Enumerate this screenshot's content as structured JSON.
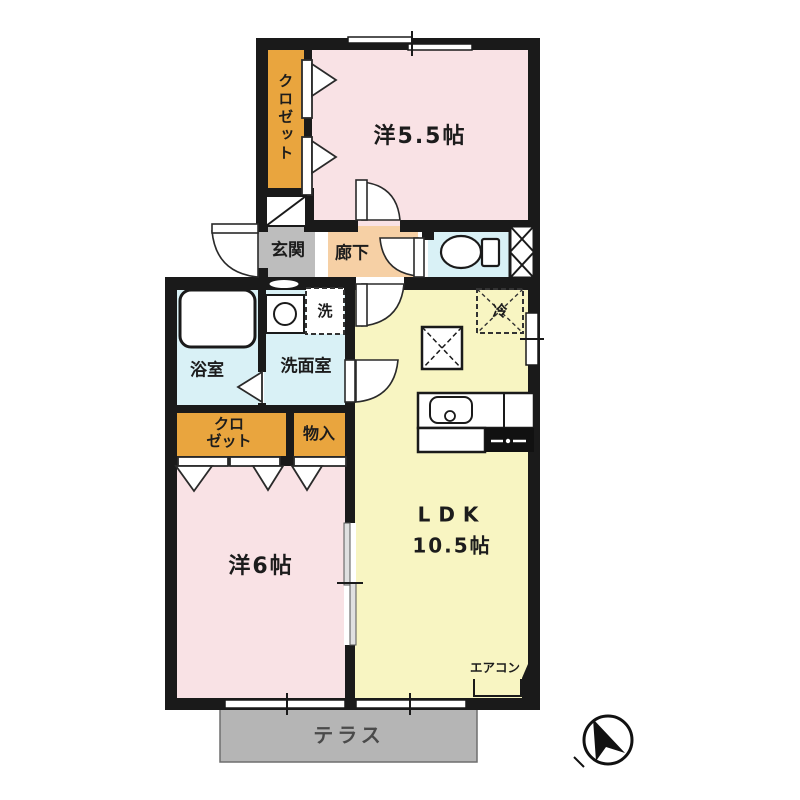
{
  "plan": {
    "type": "apartment-floor-plan",
    "layout_name": "2LDK",
    "rooms": {
      "closet_top": {
        "label": "クロゼット"
      },
      "western_55": {
        "label": "洋5.5帖"
      },
      "genkan": {
        "label": "玄関"
      },
      "hallway": {
        "label": "廊下"
      },
      "bathroom": {
        "label": "浴室"
      },
      "washroom": {
        "label": "洗面室"
      },
      "washer": {
        "label": "洗"
      },
      "fridge": {
        "label": "冷"
      },
      "closet_lower": {
        "line1": "クロ",
        "line2": "ゼット"
      },
      "storage": {
        "label": "物入"
      },
      "western_6": {
        "label": "洋6帖"
      },
      "ldk": {
        "line1": "LDK",
        "line2": "10.5帖"
      },
      "aircon": {
        "label": "エアコン"
      },
      "terrace": {
        "label": "テラス"
      }
    },
    "fixtures": [
      "bathtub",
      "washbasin",
      "washing-machine-space",
      "toilet",
      "pipe-space",
      "refrigerator-space",
      "floor-hatch",
      "kitchen-sink",
      "gas-stove",
      "entry-door",
      "hinged-doors",
      "folding-closet-doors",
      "sliding-door",
      "windows",
      "shoe-cabinet",
      "air-conditioner-spot",
      "north-arrow"
    ],
    "colors": {
      "wall": "#1a1a1a",
      "room_pink": "#f9e2e5",
      "room_yellow": "#f8f5c2",
      "wet_cyan": "#d9f1f6",
      "closet_orange": "#e9a53e",
      "hallway_peach": "#f6d0a5",
      "genkan_gray": "#bdbdbd",
      "terrace_gray": "#b5b5b5",
      "text": "#1c1c1c"
    }
  }
}
